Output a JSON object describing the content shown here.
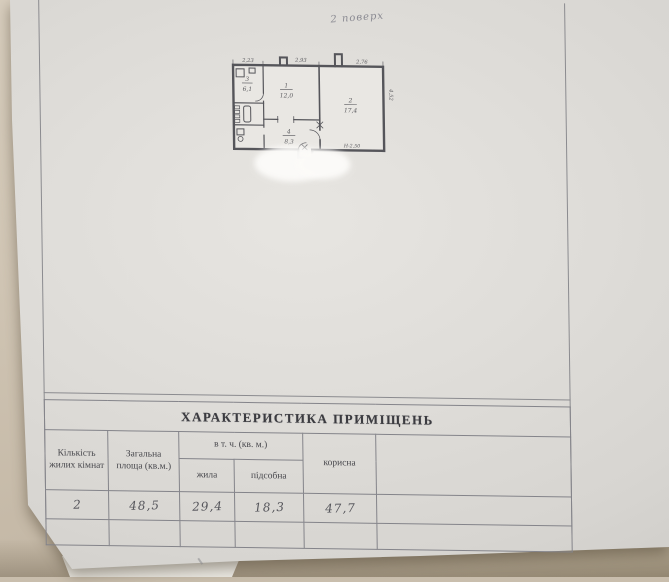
{
  "page": {
    "handwritten_note": "2 поверх"
  },
  "plan": {
    "dims": {
      "top_left": "2,23",
      "top_mid": "2,93",
      "top_right": "2,76",
      "right_side": "4,52",
      "height_mark": "Н-2,50"
    },
    "rooms": {
      "kitchen_num": "3",
      "kitchen_area": "6,1",
      "room1_num": "1",
      "room1_area": "12,0",
      "room2_num": "2",
      "room2_area": "17,4",
      "hall_num": "4",
      "hall_area": "8,3"
    }
  },
  "table": {
    "title": "ХАРАКТЕРИСТИКА ПРИМІЩЕНЬ",
    "headers": {
      "rooms_count": "Кількість жилих кімнат",
      "total_area": "Загальна площа (кв.м.)",
      "including": "в т. ч. (кв. м.)",
      "living": "жила",
      "auxiliary": "підсобна",
      "useful": "корисна"
    },
    "values": {
      "rooms_count": "2",
      "total_area": "48,5",
      "living": "29,4",
      "auxiliary": "18,3",
      "useful": "47,7"
    }
  },
  "colors": {
    "desk_background": "#c9bead",
    "paper": "#e0ded9",
    "frame_line": "#87878b",
    "pencil": "#5a5a60",
    "ink": "#3b3b40"
  }
}
